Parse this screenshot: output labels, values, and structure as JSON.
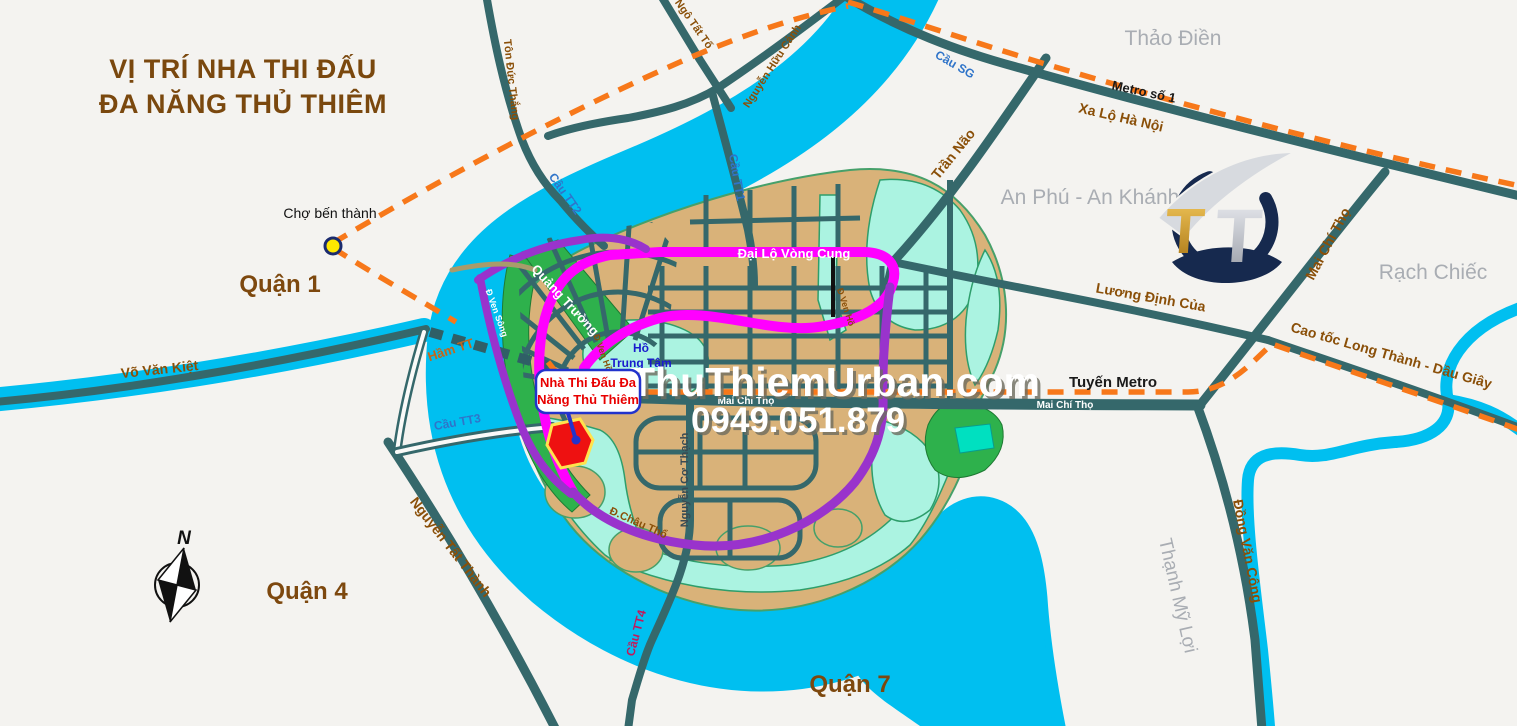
{
  "title": {
    "line1": "VỊ TRÍ NHA THI ĐẤU",
    "line2": "ĐA NĂNG THỦ THIÊM"
  },
  "watermark": {
    "site": "ThuThiemUrban.com",
    "phone": "0949.051.879"
  },
  "marker_callout": {
    "line1": "Nhà Thi Đấu Đa",
    "line2": "Năng Thủ Thiêm"
  },
  "districts": {
    "quan_1": "Quận 1",
    "quan_4": "Quận 4",
    "quan_7": "Quận 7"
  },
  "areas": {
    "thao_dien": "Thảo Điền",
    "an_phu_an_khanh": "An Phú - An Khánh",
    "rach_chiec": "Rạch Chiếc",
    "thanh_my_loi": "Thạnh Mỹ Lợi",
    "quang_truong": "Quảng Trường",
    "ho_trung_tam_line1": "Hồ",
    "ho_trung_tam_line2": "Trung Tâm"
  },
  "roads": {
    "vo_van_kiet": "Võ Văn Kiệt",
    "nguyen_tat_thanh": "Nguyễn Tất Thành",
    "ton_duc_thang": "Tôn Đức Thắng",
    "ngo_tat_to": "Ngô Tất Tố",
    "nguyen_huu_canh": "Nguyễn Hữu Cảnh",
    "xa_lo_ha_noi": "Xa Lộ Hà Nội",
    "tran_nao": "Trần Não",
    "mai_chi_tho": "Mai Chí Thọ",
    "luong_dinh_cua": "Lương Định Của",
    "cao_toc": "Cao tốc Long Thành - Dầu Giây",
    "dong_van_cong": "Đồng Văn Công",
    "nguyen_co_thach": "Nguyễn Cơ Thạch",
    "dai_lo_vong_cung": "Đại Lộ Vòng Cung",
    "d_ven_song": "Đ Ven Sông",
    "d_ven_ho": "Đ Ven Hồ",
    "d_chau_tho": "Đ.Châu Thổ"
  },
  "bridges": {
    "cau_sg": "Cầu SG",
    "cau_tt1": "Cầu TT1",
    "cau_tt2": "Cầu TT2",
    "cau_tt3": "Cầu TT3",
    "cau_tt4": "Cầu TT4",
    "ham_tt": "Hầm TT"
  },
  "transit": {
    "metro_so_1": "Metro số 1",
    "tuyen_metro": "Tuyến Metro"
  },
  "poi": {
    "cho_ben_thanh": "Chợ bến thành"
  },
  "compass": {
    "north": "N"
  },
  "logo": {
    "letter1": "T",
    "letter2": "T"
  },
  "colors": {
    "river": "#00BFF0",
    "wetland": "#ABF3E1",
    "land": "#D9B279",
    "road": "#35686B",
    "ring_road": "#FF00FF",
    "secondary_road": "#9933CC",
    "metro_line": "#F7781A",
    "marker_red": "#EE1111",
    "district_text": "#7D480E"
  }
}
